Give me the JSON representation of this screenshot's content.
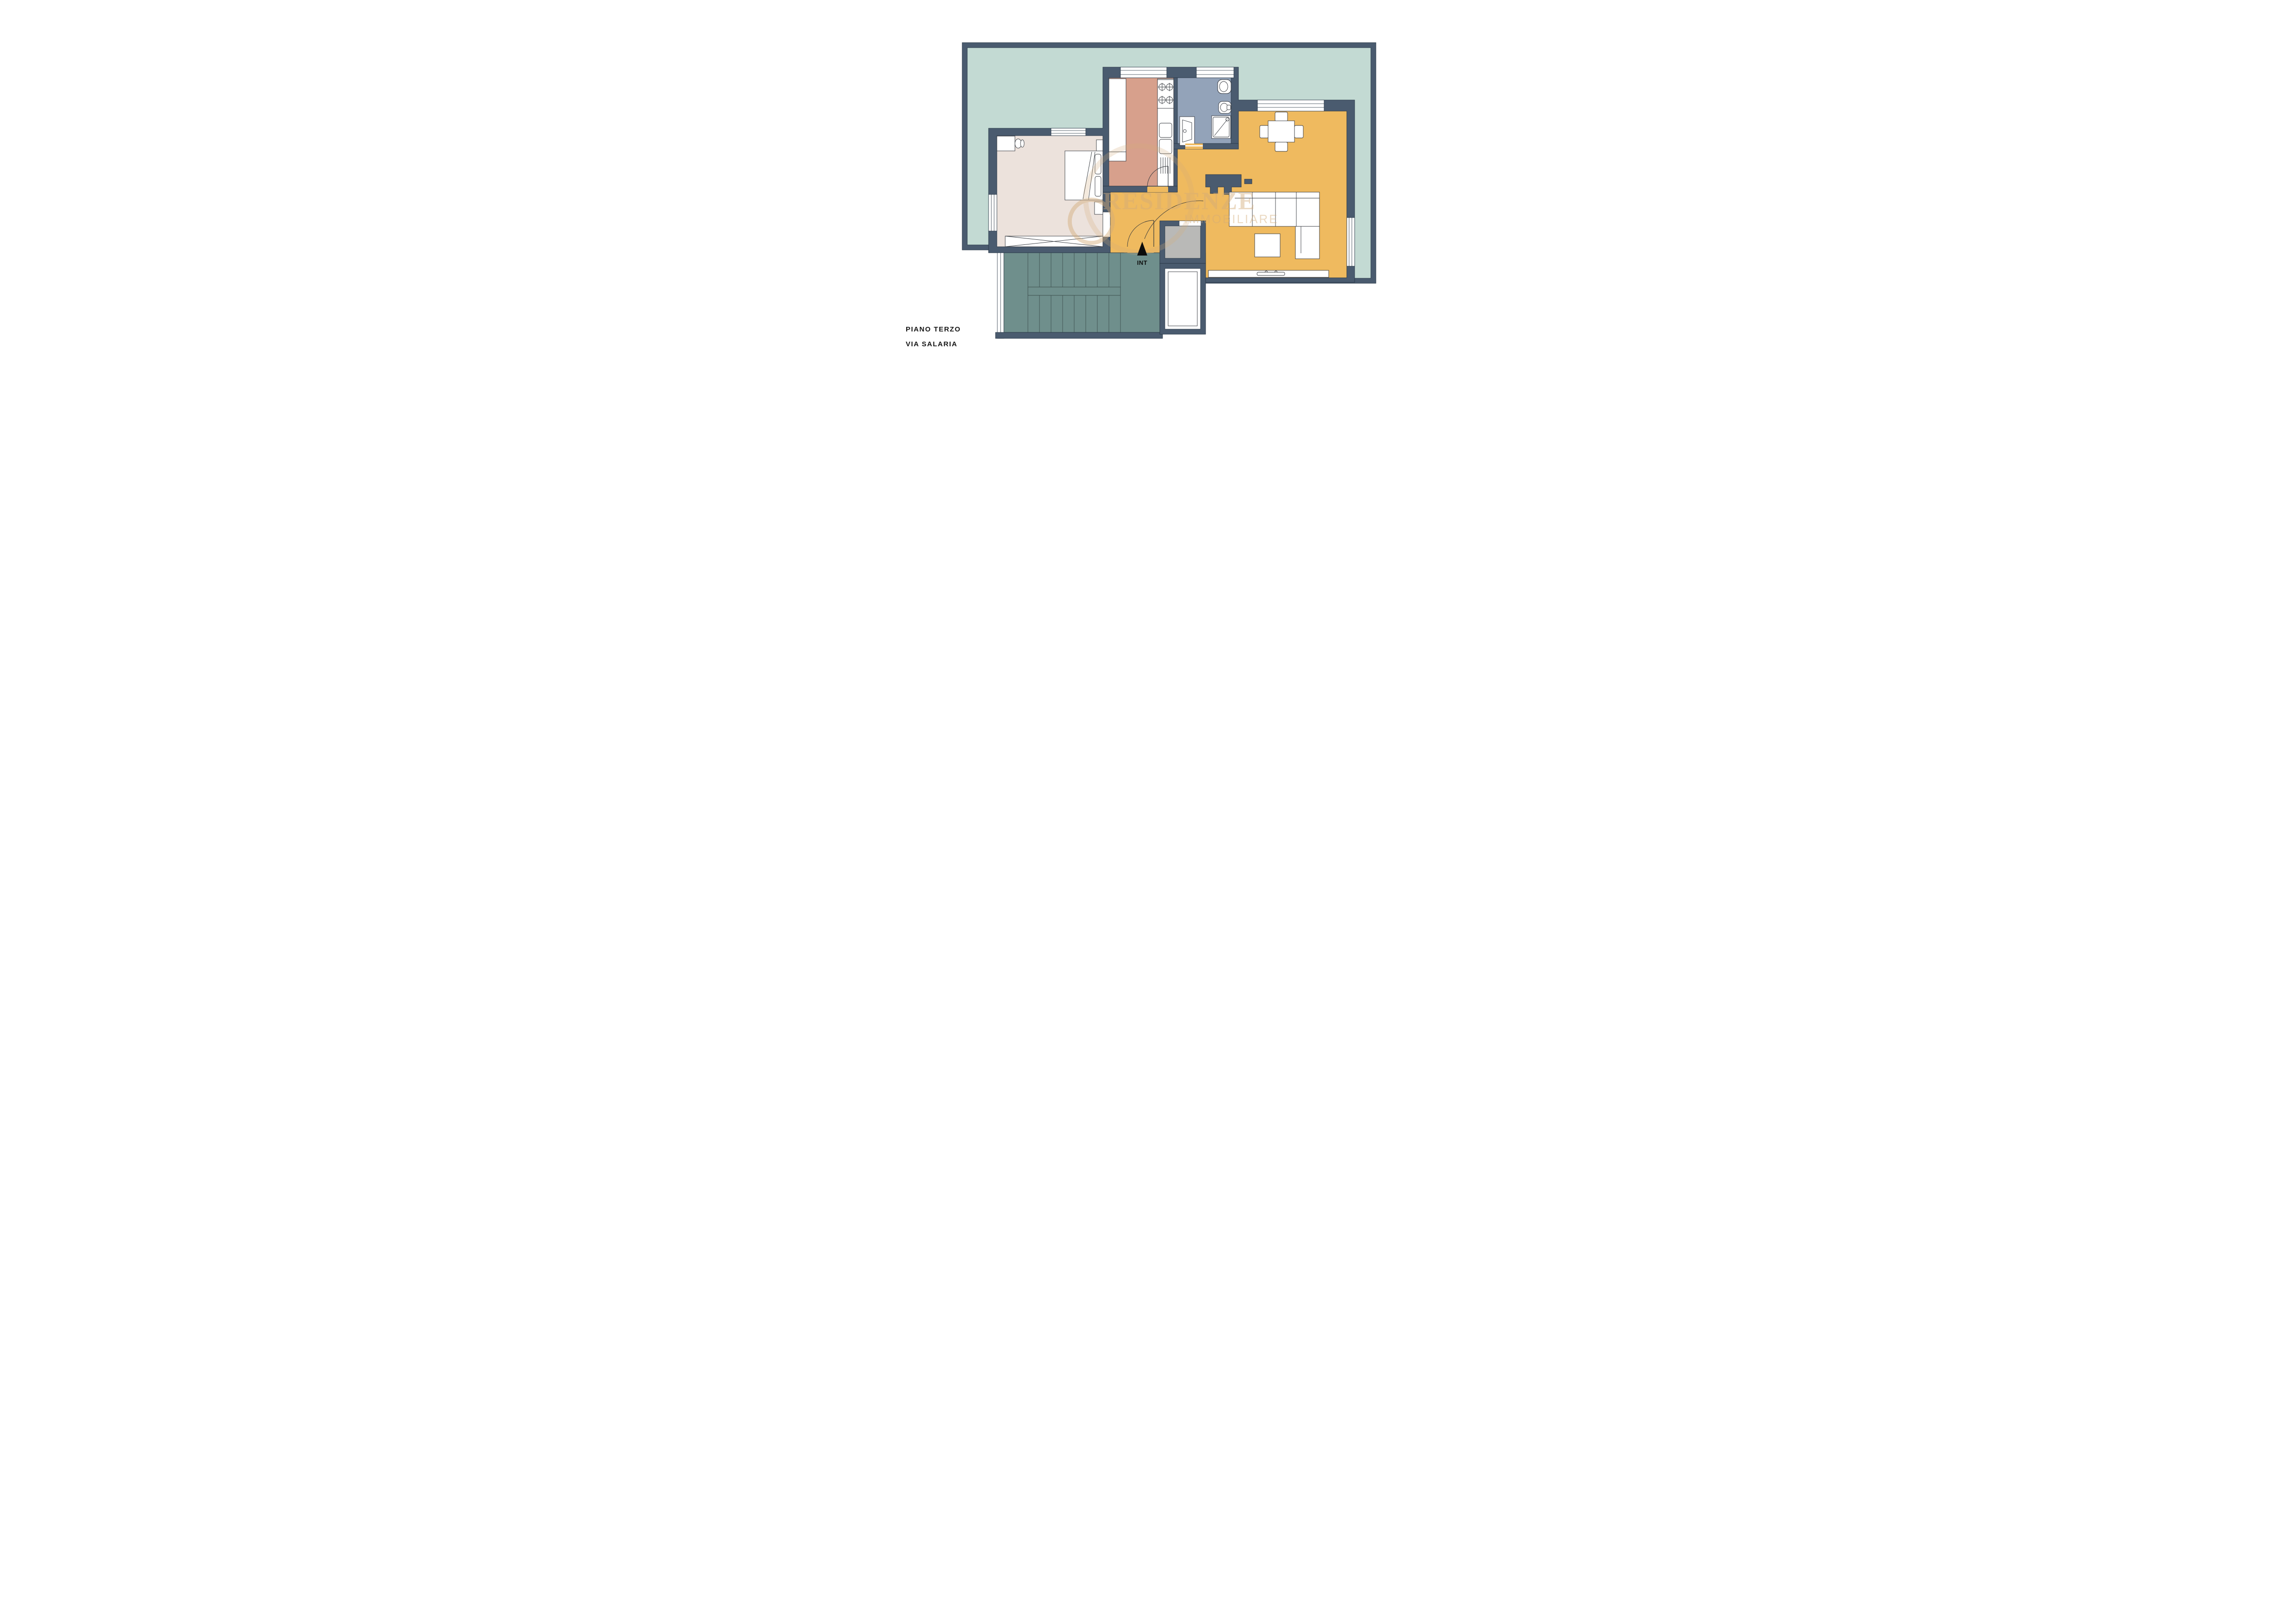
{
  "title": {
    "floor_label": "PIANO TERZO",
    "street_label": "VIA SALARIA"
  },
  "entrance": {
    "label": "INT"
  },
  "watermark": {
    "brand": "RESIDENZE",
    "brand_sub": "IMMOBILIARE"
  },
  "colors": {
    "wall": "#4a5b6f",
    "line": "#1e2835",
    "terrace": "#c3dad3",
    "bedroom": "#ece2dc",
    "kitchen": "#d7a08c",
    "bath": "#93a3b9",
    "living": "#efba5f",
    "stairs": "#6f8f8c",
    "utility": "#b9b9b7",
    "white": "#ffffff",
    "black": "#111111",
    "watermark": "#d3ac79"
  },
  "rooms": [
    {
      "id": "terrace",
      "name": "terrace"
    },
    {
      "id": "bedroom",
      "name": "bedroom"
    },
    {
      "id": "kitchen",
      "name": "kitchen"
    },
    {
      "id": "bathroom",
      "name": "bathroom"
    },
    {
      "id": "living-dining",
      "name": "living-dining room"
    },
    {
      "id": "hallway",
      "name": "hallway"
    },
    {
      "id": "stairwell",
      "name": "stairwell"
    },
    {
      "id": "utility",
      "name": "utility room"
    },
    {
      "id": "elevator",
      "name": "elevator"
    }
  ]
}
